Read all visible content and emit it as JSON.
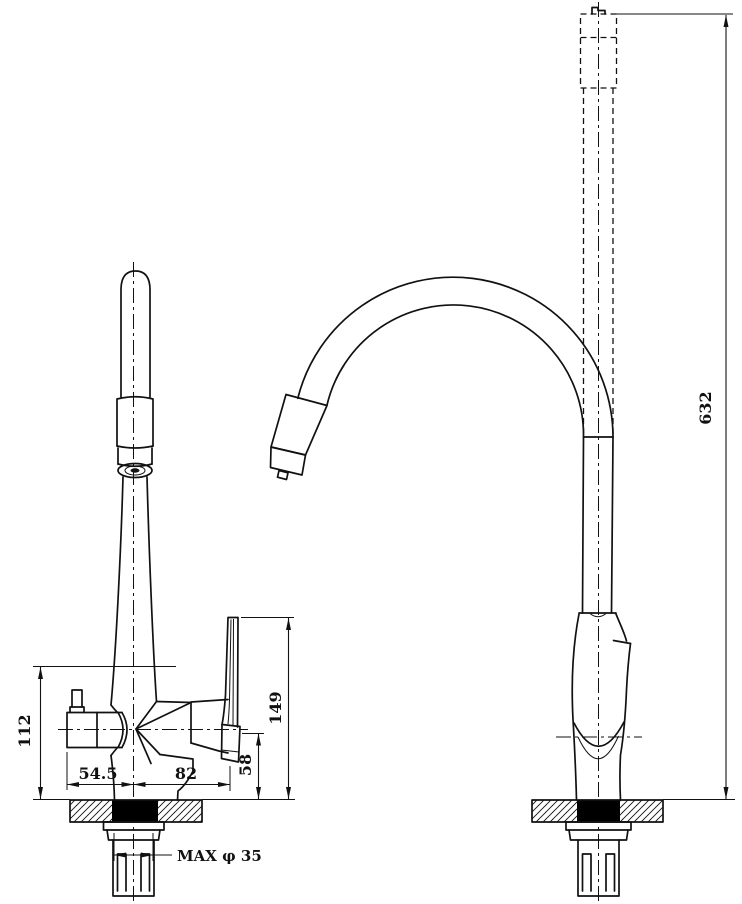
{
  "title": "Pull-out kitchen faucet dimensional drawing",
  "dimensions": {
    "body_height": "112",
    "left_offset": "54.5",
    "right_offset": "82",
    "outlet_height": "58",
    "handle_height": "149",
    "mount_hole": "MAX φ 35",
    "overall_height": "632"
  },
  "colors": {
    "line": "#111111",
    "background": "#ffffff",
    "hole_fill": "#000000"
  }
}
